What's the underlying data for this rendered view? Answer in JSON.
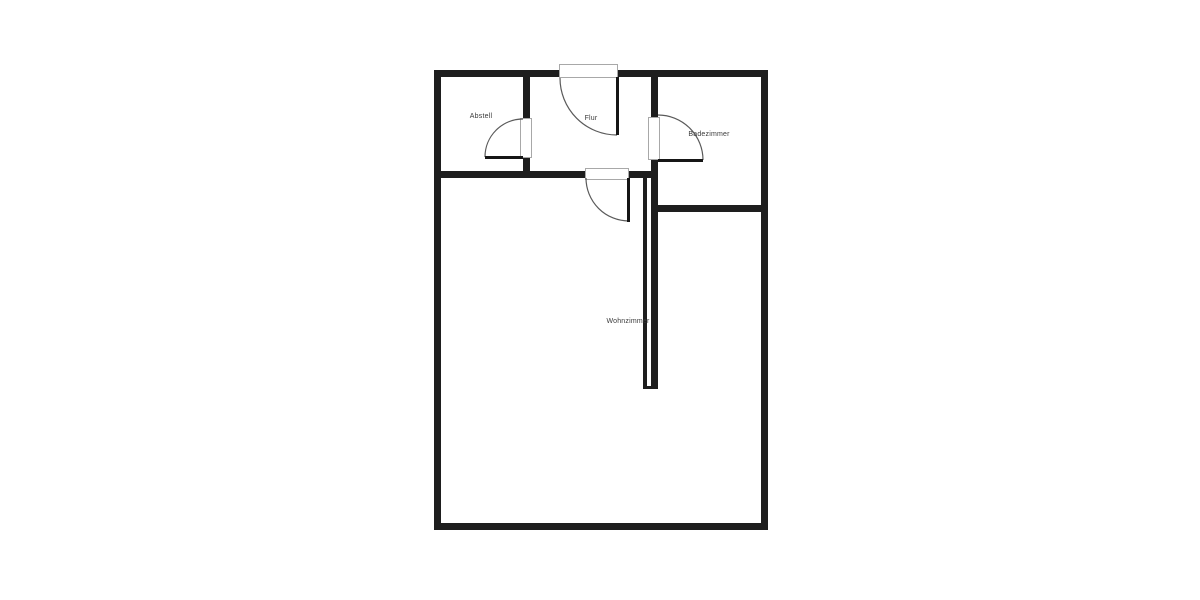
{
  "floorplan": {
    "rooms": [
      {
        "name": "abstell",
        "label": "Abstell"
      },
      {
        "name": "flur",
        "label": "Flur"
      },
      {
        "name": "badezimmer",
        "label": "Badezimmer"
      },
      {
        "name": "wohnzimmer",
        "label": "Wohnzimmer"
      }
    ],
    "doors_count": "4",
    "colors": {
      "wall": "#1e1e1e",
      "background": "#ffffff",
      "door_arc": "#5a5a5a",
      "door_frame": "#a8a8a8",
      "label_text": "#3a3a3a"
    }
  }
}
